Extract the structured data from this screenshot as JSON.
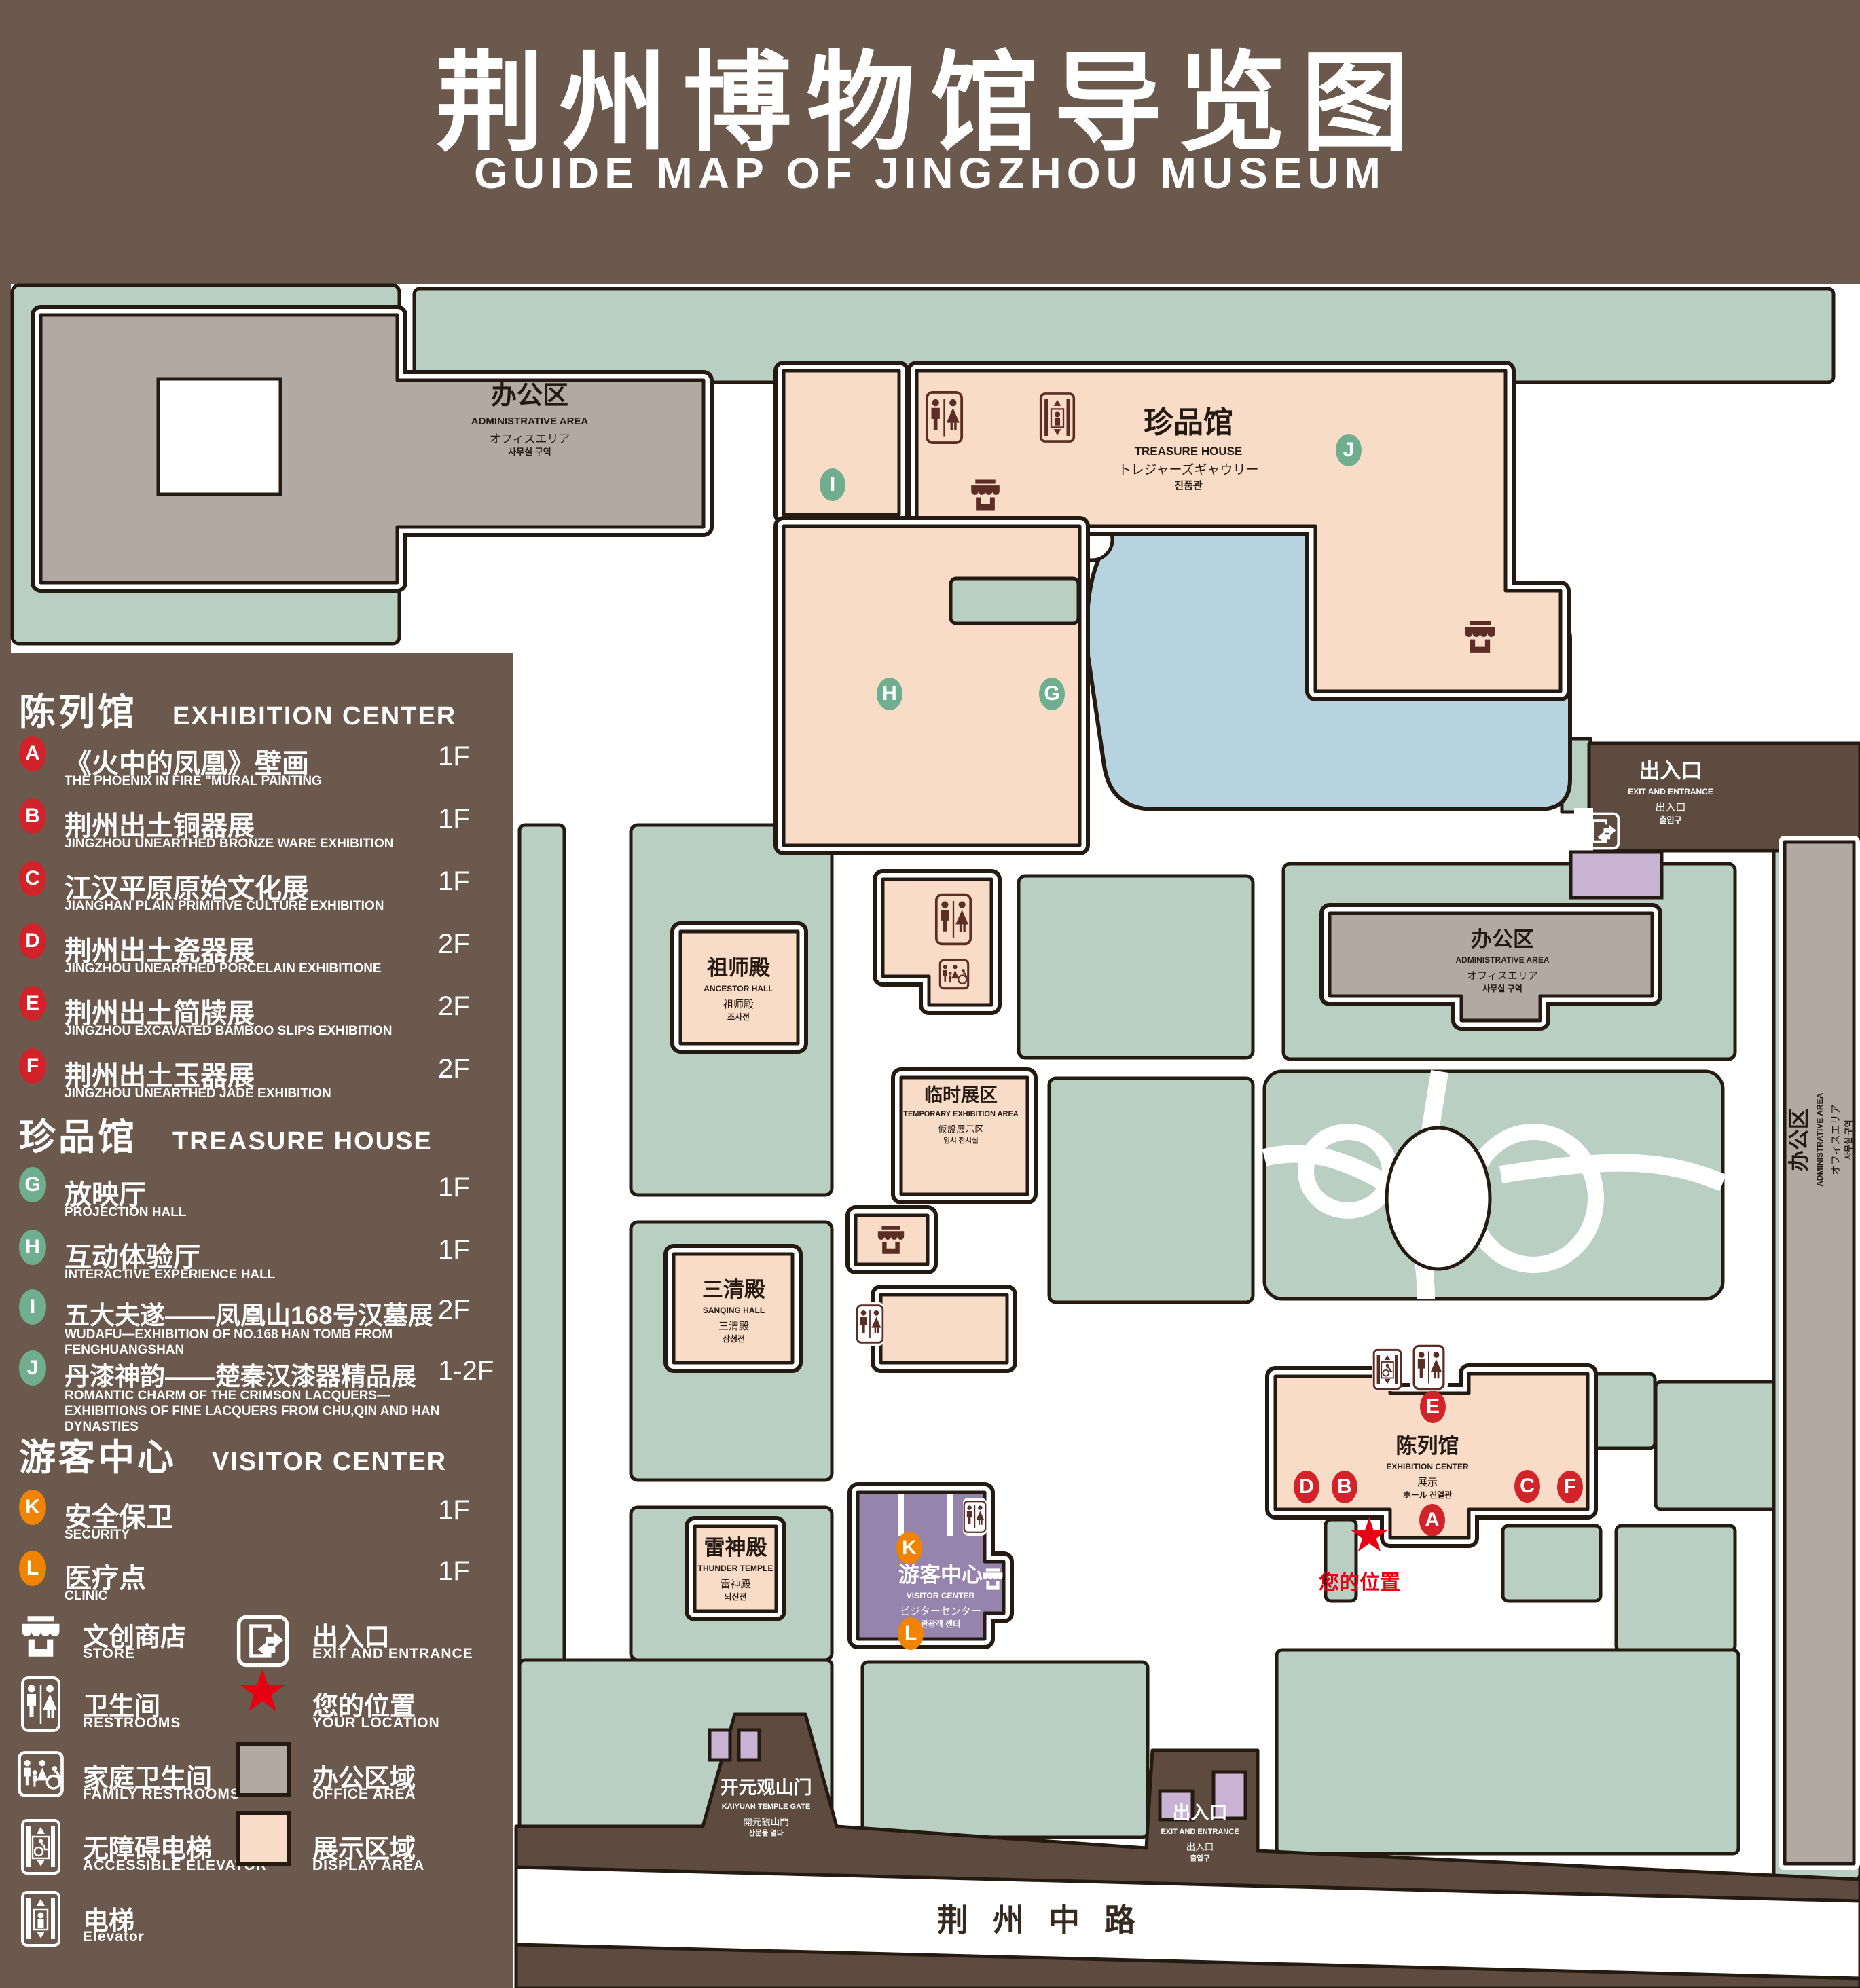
{
  "title": {
    "zh": "荆州博物馆导览图",
    "en": "GUIDE MAP OF JINGZHOU MUSEUM"
  },
  "colors": {
    "background": "#6a594c",
    "street": "#5d4b3f",
    "campus_green": "#b9cfc2",
    "display_area_pink": "#f9dcc8",
    "office_area_gray": "#b2a9a3",
    "lake_blue": "#b8d3e0",
    "visitor_center_purple": "#9684ad",
    "entrance_purple": "#c9b3d4",
    "outline": "#241a12",
    "marker_red": "#d2232a",
    "marker_green": "#6fae8e",
    "marker_orange": "#f08300",
    "icon_maroon": "#5b2d24",
    "location_red": "#e60012"
  },
  "legend": {
    "sections": [
      {
        "zh": "陈列馆",
        "en": "EXHIBITION CENTER",
        "marker_color": "#d2232a",
        "items": [
          {
            "letter": "A",
            "zh": "《火中的凤凰》壁画",
            "en": "THE PHOENIX IN FIRE \"MURAL PAINTING",
            "floor": "1F"
          },
          {
            "letter": "B",
            "zh": "荆州出土铜器展",
            "en": "JINGZHOU UNEARTHED BRONZE WARE EXHIBITION",
            "floor": "1F"
          },
          {
            "letter": "C",
            "zh": "江汉平原原始文化展",
            "en": "JIANGHAN PLAIN PRIMITIVE CULTURE EXHIBITION",
            "floor": "1F"
          },
          {
            "letter": "D",
            "zh": "荆州出土瓷器展",
            "en": "JINGZHOU UNEARTHED PORCELAIN EXHIBITIONE",
            "floor": "2F"
          },
          {
            "letter": "E",
            "zh": "荆州出土简牍展",
            "en": "JINGZHOU EXCAVATED BAMBOO SLIPS EXHIBITION",
            "floor": "2F"
          },
          {
            "letter": "F",
            "zh": "荆州出土玉器展",
            "en": "JINGZHOU UNEARTHED JADE EXHIBITION",
            "floor": "2F"
          }
        ]
      },
      {
        "zh": "珍品馆",
        "en": "TREASURE HOUSE",
        "marker_color": "#6fae8e",
        "items": [
          {
            "letter": "G",
            "zh": "放映厅",
            "en": "PROJECTION HALL",
            "floor": "1F"
          },
          {
            "letter": "H",
            "zh": "互动体验厅",
            "en": "INTERACTIVE EXPERIENCE HALL",
            "floor": "1F"
          },
          {
            "letter": "I",
            "zh": "五大夫遂——凤凰山168号汉墓展",
            "en": "WUDAFU—EXHIBITION OF NO.168 HAN TOMB FROM FENGHUANGSHAN",
            "floor": "2F"
          },
          {
            "letter": "J",
            "zh": "丹漆神韵——楚秦汉漆器精品展",
            "en": "ROMANTIC CHARM OF THE CRIMSON LACQUERS—EXHIBITIONS OF FINE LACQUERS FROM CHU,QIN AND HAN DYNASTIES",
            "floor": "1-2F"
          }
        ]
      },
      {
        "zh": "游客中心",
        "en": "VISITOR CENTER",
        "marker_color": "#f08300",
        "items": [
          {
            "letter": "K",
            "zh": "安全保卫",
            "en": "SECURITY",
            "floor": "1F"
          },
          {
            "letter": "L",
            "zh": "医疗点",
            "en": "CLINIC",
            "floor": "1F"
          }
        ]
      }
    ],
    "symbols": {
      "col1": [
        {
          "icon": "store-icon",
          "zh": "文创商店",
          "en": "STORE"
        },
        {
          "icon": "restrooms-icon",
          "zh": "卫生间",
          "en": "RESTROOMS"
        },
        {
          "icon": "family-restrooms-icon",
          "zh": "家庭卫生间",
          "en": "FAMILY RESTROOMS"
        },
        {
          "icon": "accessible-elevator-icon",
          "zh": "无障碍电梯",
          "en": "ACCESSIBLE  ELEVATOR"
        },
        {
          "icon": "elevator-icon",
          "zh": "电梯",
          "en": "Elevator"
        }
      ],
      "col2": [
        {
          "icon": "exit-icon",
          "zh": "出入口",
          "en": "EXIT AND ENTRANCE"
        },
        {
          "icon": "location-star-icon",
          "zh": "您的位置",
          "en": "YOUR LOCATION"
        },
        {
          "icon": "office-area-swatch",
          "zh": "办公区域",
          "en": "OFFICE AREA"
        },
        {
          "icon": "display-area-swatch",
          "zh": "展示区域",
          "en": "DISPLAY AREA"
        }
      ]
    }
  },
  "map": {
    "buildings": {
      "admin": {
        "zh": "办公区",
        "en": "ADMINISTRATIVE AREA",
        "ja": "オフィスエリア",
        "ko": "사무실 구역"
      },
      "treasure": {
        "zh": "珍品馆",
        "en": "TREASURE HOUSE",
        "ja": "トレジャーズギャウリー",
        "ko": "진품관"
      },
      "ancestor": {
        "zh": "祖师殿",
        "en": "ANCESTOR HALL",
        "ja": "祖师殿",
        "ko": "조사전"
      },
      "temporary": {
        "zh": "临时展区",
        "en": "TEMPORARY EXHIBITION AREA",
        "ja": "仮設展示区",
        "ko": "임시 전시실"
      },
      "sanqing": {
        "zh": "三清殿",
        "en": "SANQING HALL",
        "ja": "三清殿",
        "ko": "삼청전"
      },
      "thunder": {
        "zh": "雷神殿",
        "en": "THUNDER TEMPLE",
        "ja": "雷神殿",
        "ko": "뇌신전"
      },
      "visitor": {
        "zh": "游客中心",
        "en": "VISITOR CENTER",
        "ja": "ビジターセンター",
        "ko": "관광객 센터"
      },
      "exhibition": {
        "zh": "陈列馆",
        "en": "EXHIBITION CENTER",
        "ja": "展示",
        "ko": "ホール  진열관"
      },
      "gate": {
        "zh": "开元观山门",
        "en": "KAIYUAN TEMPLE GATE",
        "ja": "開元観山門",
        "ko": "산문을 열다"
      },
      "exit": {
        "zh": "出入口",
        "en": "EXIT AND ENTRANCE",
        "ja": "出入口",
        "ko": "출입구"
      }
    },
    "road": "荆州中路",
    "your_location": "您的位置",
    "location_star": "★",
    "markers": [
      "A",
      "B",
      "C",
      "D",
      "E",
      "F",
      "G",
      "H",
      "I",
      "J",
      "K",
      "L"
    ]
  }
}
